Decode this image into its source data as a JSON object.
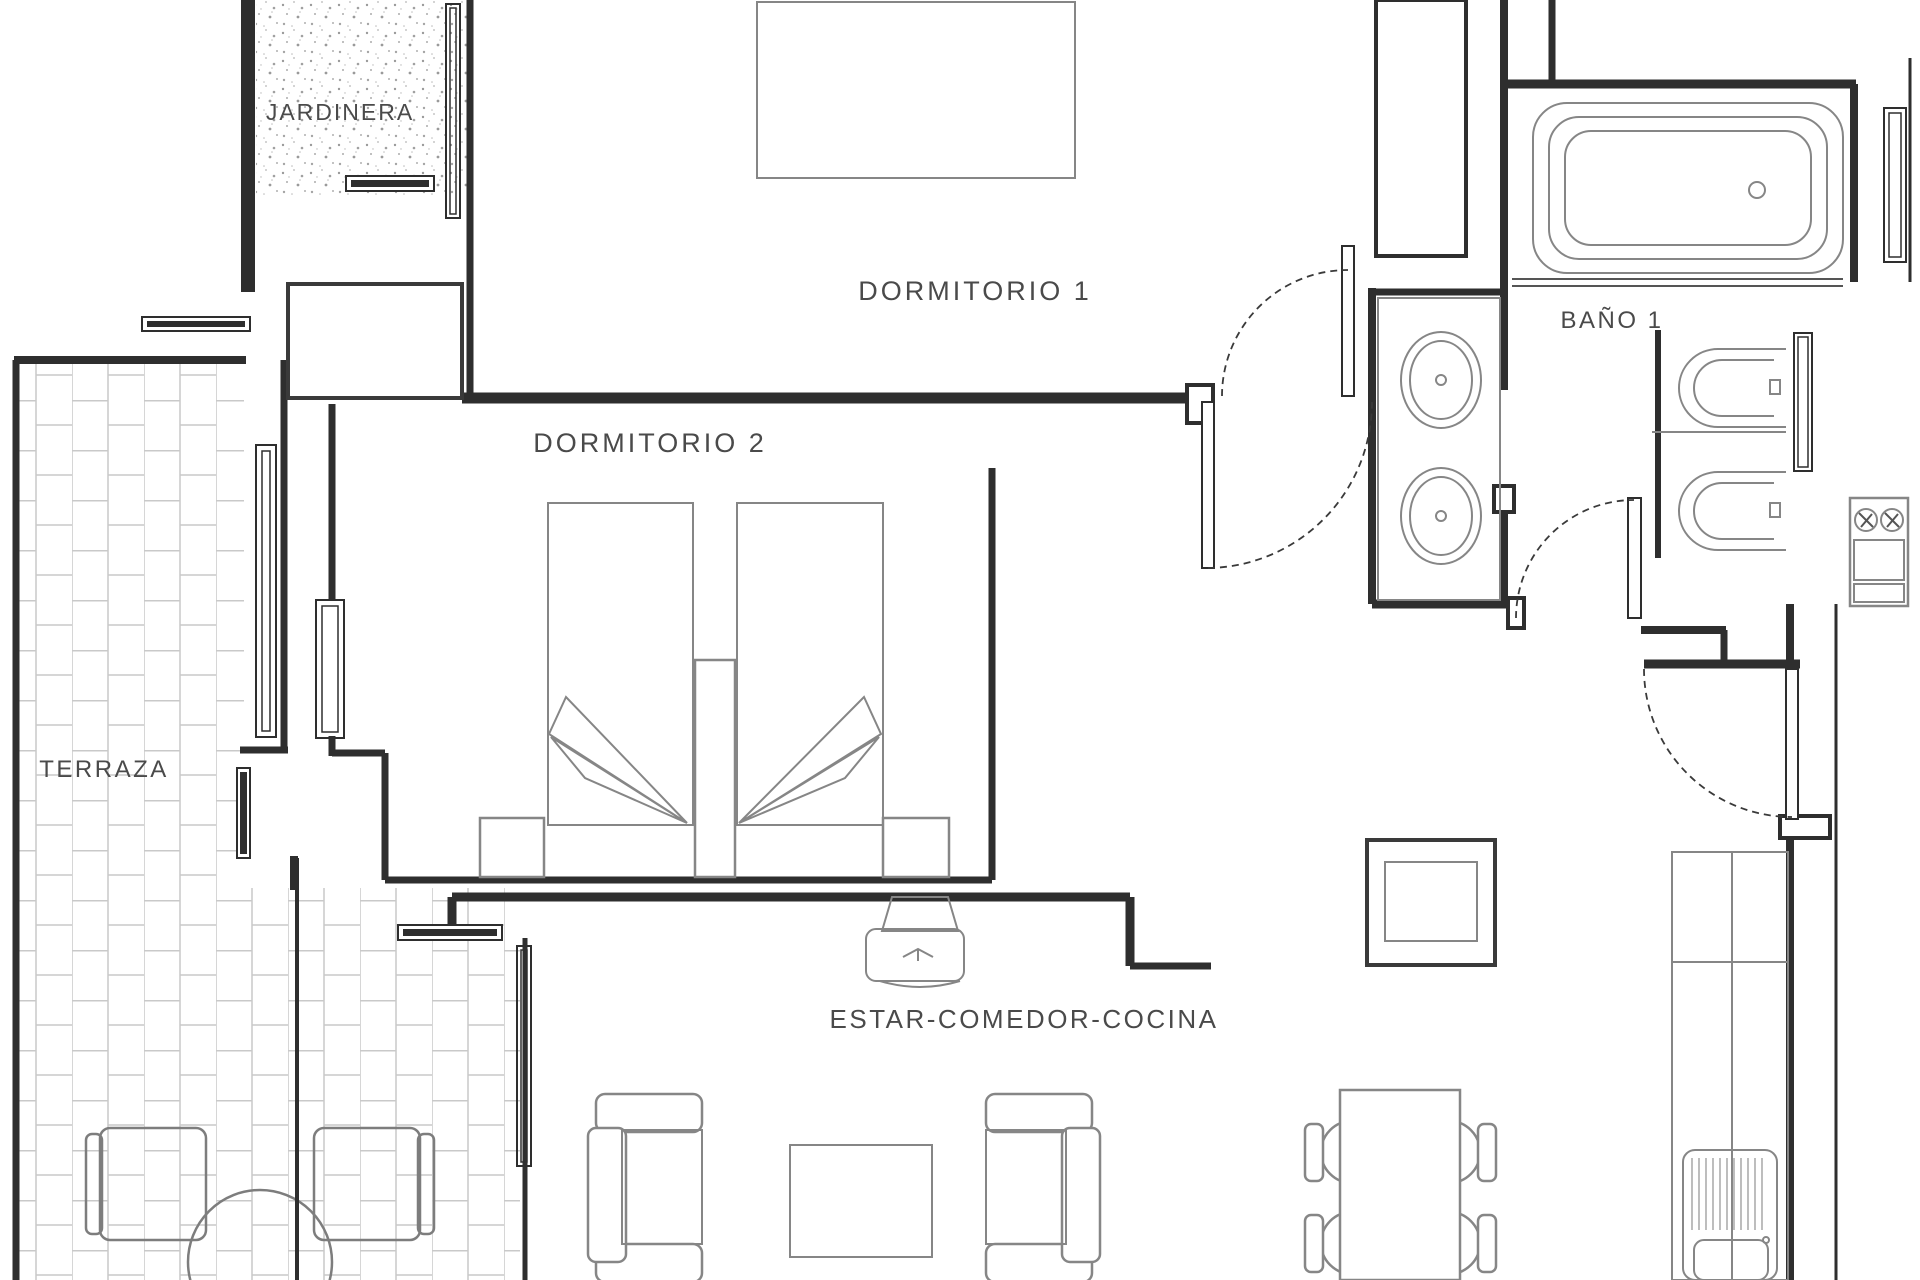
{
  "labels": {
    "jardinera": "JARDINERA",
    "dormitorio1": "DORMITORIO 1",
    "dormitorio2": "DORMITORIO 2",
    "terraza": "TERRAZA",
    "bano1": "BAÑO 1",
    "estar": "ESTAR-COMEDOR-COCINA"
  },
  "colors": {
    "wall": "#2e2e2e",
    "furniture": "#868686",
    "tile_joint": "#c9c9c9",
    "label_text": "#4a4a4a",
    "background": "#ffffff"
  }
}
